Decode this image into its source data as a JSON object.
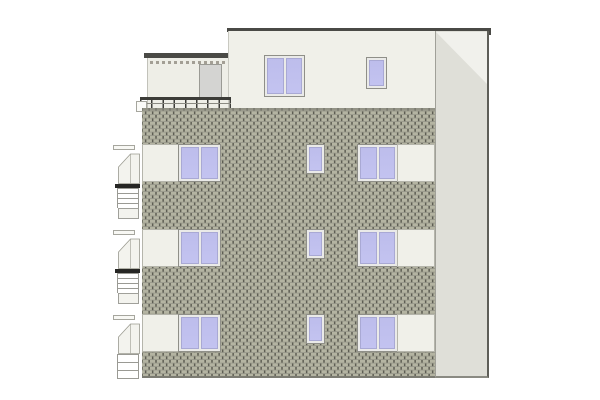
{
  "drawing": {
    "title": "Residential building side elevation - architectural drawing",
    "type": "architectural-elevation",
    "floors_visible": 4,
    "summary": {
      "double_casement_windows": 7,
      "single_casement_windows": 4,
      "roof_terrace_with_railing": 1,
      "penthouse_door": 1,
      "side_balconies_left_edge": 3
    }
  },
  "colors": {
    "background": "#ffffff",
    "wall_cream": "#f0f0e9",
    "penthouse_wall": "#eeeee7",
    "brick_face": "#b4b4a2",
    "brick_joint_dark": "#5d5d53",
    "brick_joint_light": "#97978a",
    "roof_dark": "#4a4a46",
    "side_panel": "#dfdfd8",
    "side_panel_highlight": "#f1f1ec",
    "window_glass": "#c3c3f0",
    "window_frame": "#eaeae8",
    "door_gray": "#d4d4d2",
    "outline_gray": "#9a9a90",
    "railing_light": "#9a9a94"
  },
  "components": {
    "main_roof": "flat roof slab with parapet",
    "penthouse": "set-back penthouse with roof terrace",
    "terrace_railing": "metal guard railing on roof terrace",
    "brick_wall": "running-bond brick facade",
    "side_return": "recessed side wall panel",
    "window_bands": "cream spandrel bands at each floor",
    "oriel_bays": "projecting corner bays with balcony rails on left edge"
  }
}
